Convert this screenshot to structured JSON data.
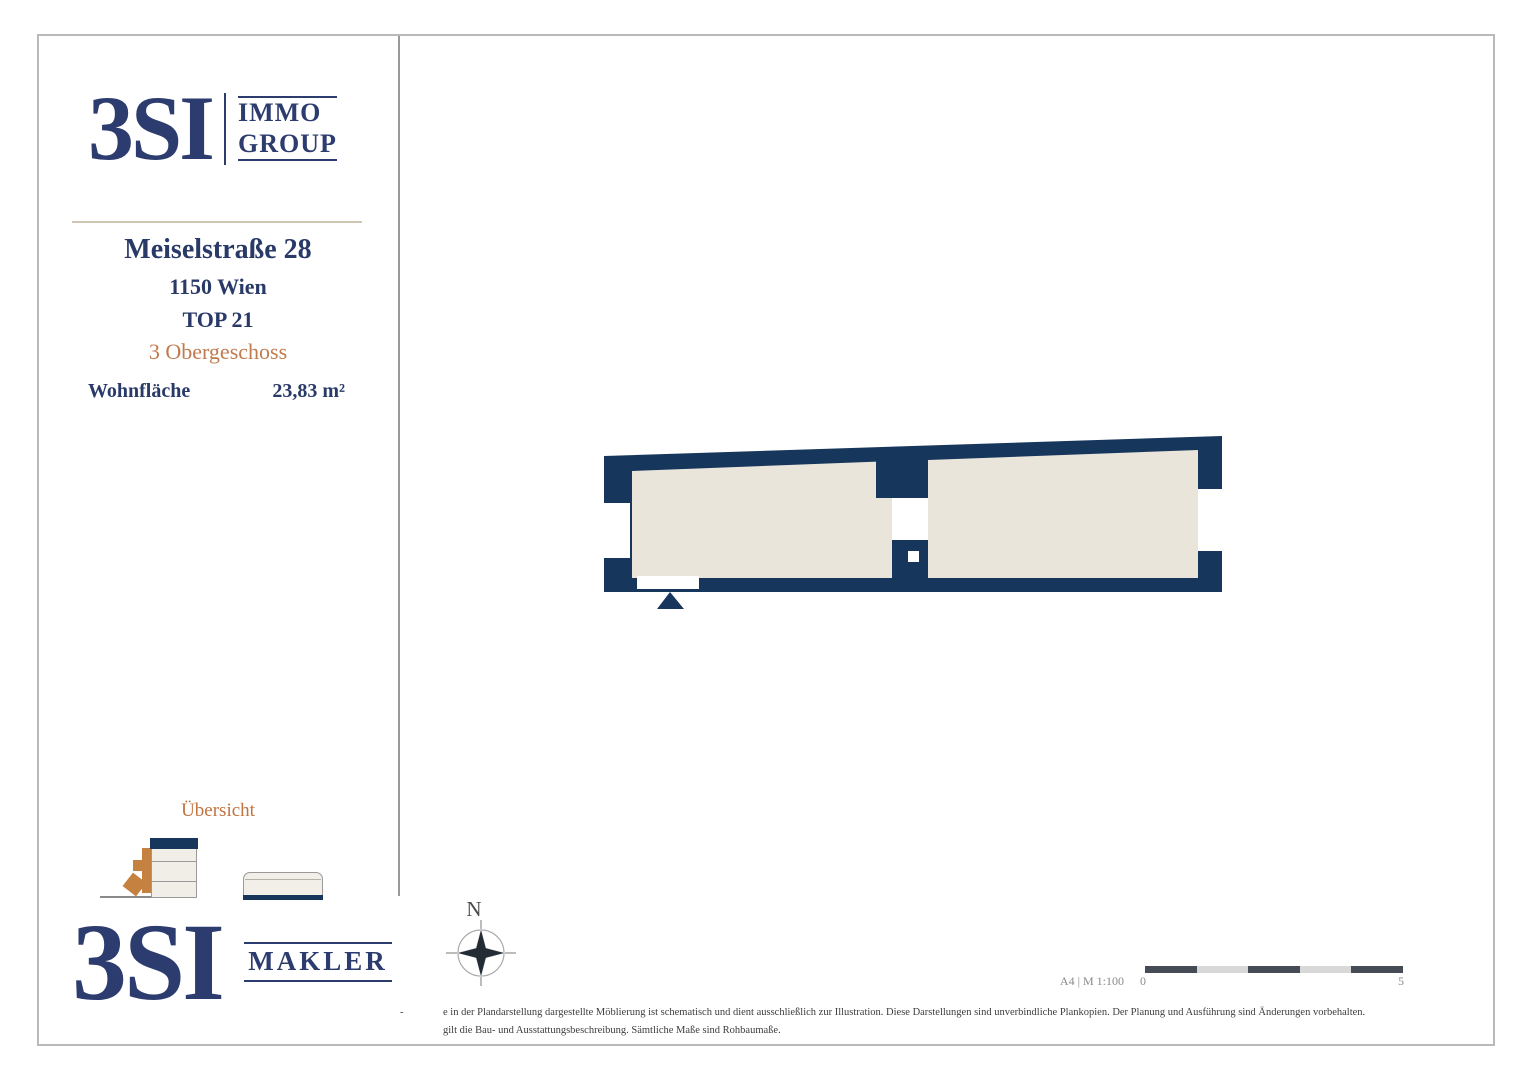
{
  "brand_header": {
    "name": "3SI",
    "sub1": "IMMO",
    "sub2": "GROUP"
  },
  "property": {
    "street": "Meiselstraße 28",
    "city": "1150 Wien",
    "unit": "TOP 21",
    "floor": "3 Obergeschoss",
    "area_label": "Wohnfläche",
    "area_value": "23,83 m²"
  },
  "overview_label": "Übersicht",
  "brand_footer": {
    "name": "3SI",
    "sub1": "MAKLER"
  },
  "compass_label": "N",
  "scale_bar": {
    "caption": "A4 | M 1:100",
    "start": "0",
    "end": "5"
  },
  "disclaimer": {
    "dash": "-",
    "line1": "e in der Plandarstellung dargestellte Möblierung ist schematisch und dient ausschließlich zur Illustration. Diese Darstellungen sind unverbindliche Plankopien. Der Planung und Ausführung sind Änderungen vorbehalten.",
    "line2": "gilt die Bau- und Ausstattungsbeschreibung. Sämtliche Maße sind Rohbaumaße."
  },
  "colors": {
    "navy_walls": "#17365c",
    "navy_text": "#2c3c6e",
    "floor_beige": "#eae5db",
    "accent_orange": "#c17b4e"
  }
}
